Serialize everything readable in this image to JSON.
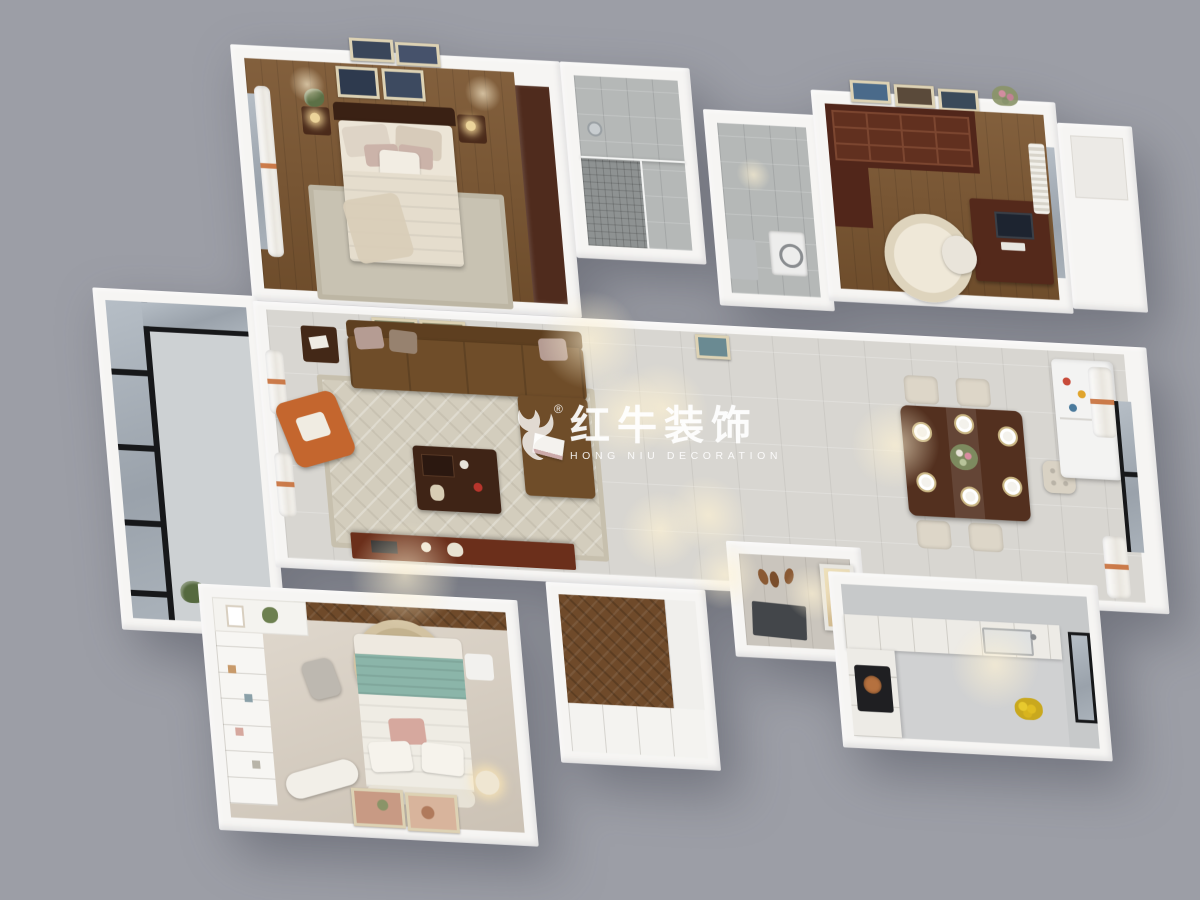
{
  "watermark": {
    "brand_cn": "红牛装饰",
    "brand_en": "HONG NIU DECORATION",
    "registered_mark": "®",
    "logo_icon": "bull-logo"
  },
  "palette": {
    "background": "#9c9ea6",
    "wall": "#f6f5f3",
    "wood_floor": "#7b5631",
    "tile_floor": "#d8d6d1",
    "bath_tile": "#b5b8b7",
    "closet_floor": "#6f4a2a",
    "carpet": "#d8cec0",
    "dark_wood": "#4f2b1d",
    "mahogany": "#51261a",
    "sofa_brown": "#6f4d29",
    "accent_orange": "#c4662e",
    "teal_blanket": "#8bb5a9",
    "fridge_white": "#f3f3f2",
    "window_frame_black": "#17181a",
    "watermark_white": "rgba(255,255,255,0.88)"
  }
}
